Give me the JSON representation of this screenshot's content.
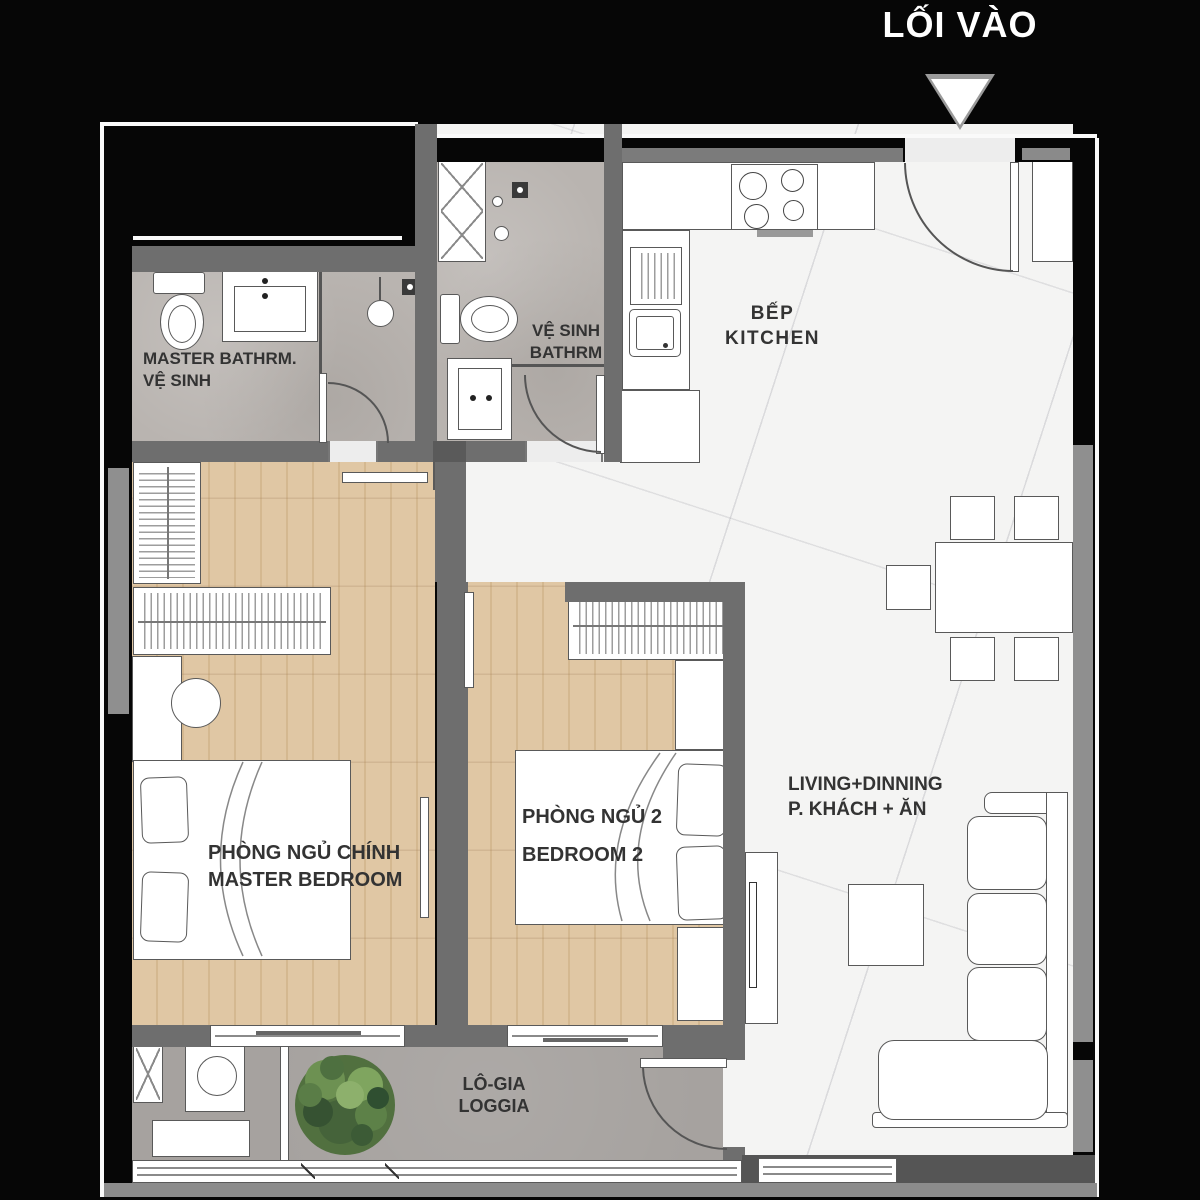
{
  "title": "2-bedroom apartment floor plan",
  "entrance": {
    "label": "LỐI VÀO"
  },
  "rooms": {
    "kitchen": {
      "line1": "BẾP",
      "line2": "KITCHEN"
    },
    "master_bathroom": {
      "line1": "MASTER BATHRM.",
      "line2": "VỆ SINH"
    },
    "bathroom2": {
      "line1": "VỆ SINH",
      "line2": "BATHRM"
    },
    "master_bedroom": {
      "line1": "PHÒNG NGỦ CHÍNH",
      "line2": "MASTER BEDROOM"
    },
    "bedroom2": {
      "line1": "PHÒNG NGỦ 2",
      "line2": "BEDROOM 2"
    },
    "living_dining": {
      "line1": "LIVING+DINNING",
      "line2": "P. KHÁCH + ĂN"
    },
    "loggia": {
      "line1": "LÔ-GIA",
      "line2": "LOGGIA"
    }
  },
  "colors": {
    "black": "#060606",
    "wall": "#6e6e6e",
    "window-gray": "#8f8f8f",
    "marble": "#f4f4f3",
    "bath": "#b9b4b0",
    "wood": "#e0c7a4",
    "loggia": "#a6a29f",
    "white": "#ffffff",
    "line": "#595959",
    "text": "#333333",
    "plant-dark": "#45633a",
    "plant-mid": "#6d9152",
    "plant-light": "#8db06c"
  }
}
